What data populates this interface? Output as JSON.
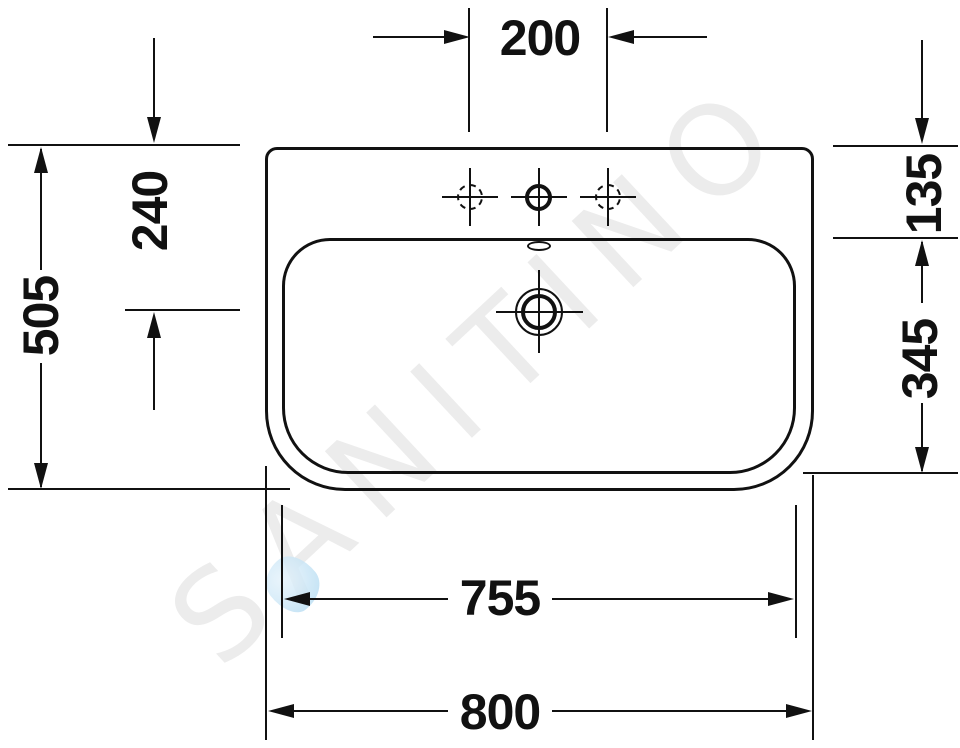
{
  "drawing": {
    "type": "washbasin-top-view-technical-drawing",
    "dimensions": {
      "faucet_hole_spacing": "200",
      "top_edge_to_drain_center": "240",
      "overall_depth": "505",
      "top_edge_to_basin": "135",
      "basin_depth": "345",
      "basin_width": "755",
      "overall_width": "800"
    },
    "watermark": {
      "text": "SANITINO",
      "color": "#ececec",
      "droplet_color": "#b9def2"
    },
    "colors": {
      "line": "#111111",
      "background": "#ffffff"
    }
  }
}
